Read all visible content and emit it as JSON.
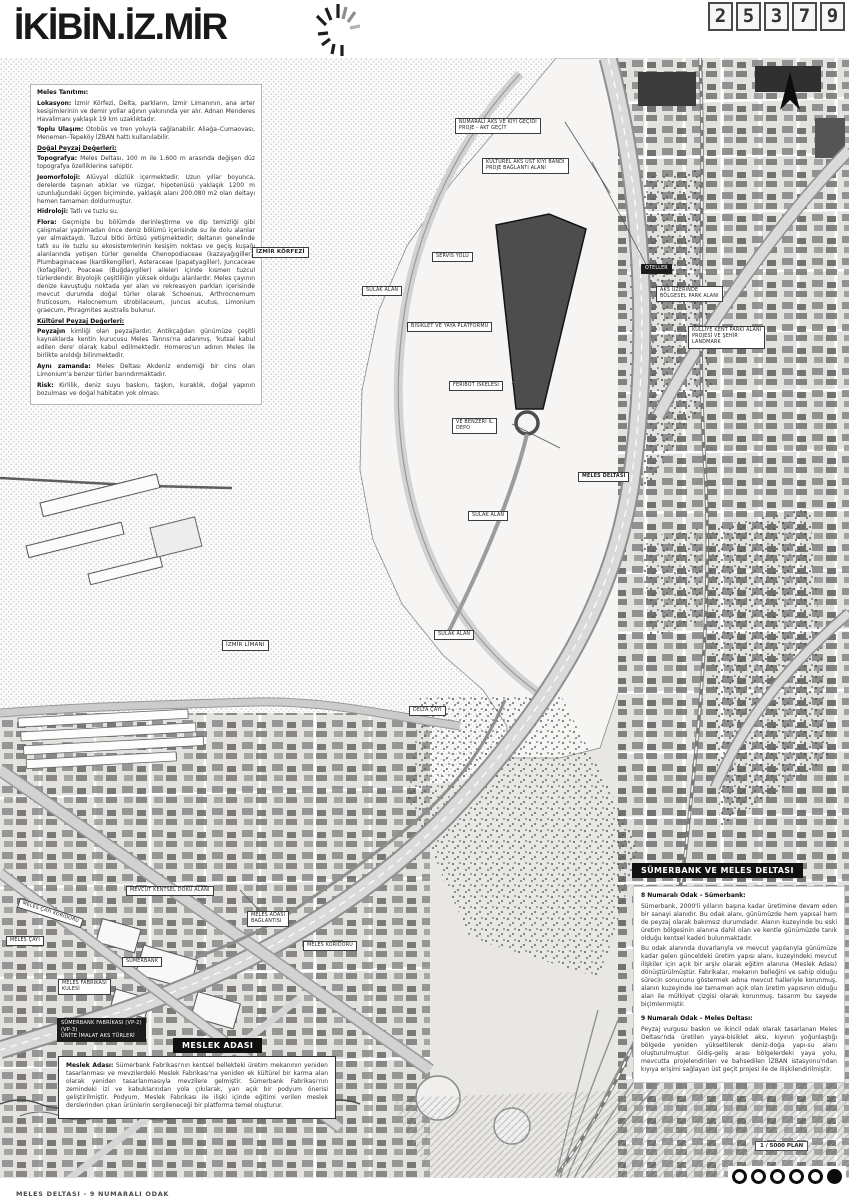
{
  "header": {
    "logo": "İKİBİN.İZ.MİR",
    "code_digits": [
      "2",
      "5",
      "3",
      "7",
      "9"
    ]
  },
  "footer": {
    "caption": "MELES DELTASI - 9 NUMARALI ODAK",
    "scale": "1 / 5000 PLAN"
  },
  "labels": {
    "callout1": "NUMARALI AKS VE KIYI GEÇİDİ\nPROJE - AKT GEÇİT",
    "callout2": "KÜLTÜREL AKS ÜST KIYI BANDI\nPROJE BAĞLANTI ALANI",
    "izmir_korfezi": "İZMİR KÖRFEZİ",
    "servis_yolu": "SERVİS YOLU",
    "sulak_alan_1": "SULAK ALAN",
    "bisiklet": "BİSİKLET VE YAYA PLATFORMU",
    "feribot": "FERİBOT İSKELESİ",
    "depo": "VE BENZERİ İL\nDEPO",
    "meles_deltasi": "MELES DELTASI",
    "sulak_alan_2": "SULAK ALAN",
    "izmir_limani": "İZMİR LİMANI",
    "sulak_alan_3": "SULAK ALAN",
    "delta_cayi": "DELTA ÇAYI",
    "oteller": "OTELLER",
    "aks_parki": "AKS ÜZERİNDE\nBÖLGESEL PARK ALANI",
    "landmark": "KÜLLİYE KENT PARKI ALANI\nPROJESİ VE ŞEHİR\nLANDMARK",
    "mevcut_doku": "MEVCUT KENTSEL DOKU ALANI",
    "koridor": "MELES ÇAYI KORİDORU",
    "meles_cayi": "MELES ÇAYI",
    "sumerbank": "SÜMERBANK",
    "fabrika": "MELES FABRİKASI\nKULESİ",
    "adasi_baglanti": "MELES ADASI\nBAĞLANTISI",
    "meles_koridoru": "MELES KORİDORU",
    "vp_box": "SÜMERBANK FABRİKASI (VP-2)\n(VP-3)\nÜNİTE İMALAT AKS TÜRLERİ"
  },
  "info": {
    "p1": {
      "b": "Meles Tanıtımı:",
      "t": ""
    },
    "p2": {
      "b": "Lokasyon:",
      "t": "İzmir Körfezi, Delta, parkların, İzmir Limanının, ana arter kesişimlerinin ve demir yollar ağının yakınında yer alır. Adnan Menderes Havalimanı yaklaşık 19 km uzaklıktadır."
    },
    "p3": {
      "b": "Toplu Ulaşım:",
      "t": "Otobüs ve tren yoluyla sağlanabilir. Aliağa–Cumaovası, Menemen–Tepeköy İZBAN hattı kullanılabilir."
    },
    "p4": {
      "b": "Doğal Peyzaj Değerleri:",
      "t": ""
    },
    "p5": {
      "b": "Topografya:",
      "t": "Meles Deltası, 100 m ile 1.600 m arasında değişen düz topografya özelliklerine sahiptir."
    },
    "p6": {
      "b": "Jeomorfoloji:",
      "t": "Alüvyal düzlük içermektedir. Uzun yıllar boyunca, derelerde taşınan atıklar ve rüzgar, hipotenüsü yaklaşık 1200 m uzunluğundaki üçgen biçiminde, yaklaşık alanı 200.080 m2 olan deltayı hemen tamamen doldurmuştur."
    },
    "p7": {
      "b": "Hidroloji:",
      "t": "Tatlı ve tuzlu su."
    },
    "p8": {
      "b": "Flora:",
      "t": "Geçmişte bu bölümde derinleştirme ve dip temizliği gibi çalışmalar yapılmadan önce deniz bölümü içerisinde su ile dolu alanlar yer almaktaydı. Tuzcul bitki örtüsü yetişmektedir; deltanın genelinde tatlı su ile tuzlu su ekosistemlerinin kesişim noktası ve geçiş kuşağı alanlarında yetişen türler genelde Chenopodiaceae (kazayağıgiller), Plumbaginaceae (kardikengiller), Asteraceae (papatyagiller), Juncaceae (kofagiller), Poaceae (Buğdaygiller) aileleri içinde kısmen tuzcul türlerdendir. Biyolojik çeşitliliğin yüksek olduğu alanlardır. Meles çayının denize kavuştuğu noktada yer alan ve rekreasyon parkları içerisinde mevcut durumda doğal türler olarak Schoenus, Arthrocnemum fruticosum, Halocnemum strobilaceum, Juncus acutus, Limonium graecum, Phragmites australis bulunur."
    },
    "p9": {
      "b": "Kültürel Peyzaj Değerleri:",
      "t": ""
    },
    "p10": {
      "b": "Peyzajın",
      "t": "kimliği olan peyzajlardır; Antikçağdan günümüze çeşitli kaynaklarda kentin kurucusu Meles Tanrısı'na adanmış, 'kutsal kabul edilen dere' olarak kabul edilmektedir. Homeros'un adının Meles ile birlikte anıldığı bilinmektedir."
    },
    "p11": {
      "b": "Aynı zamanda:",
      "t": "Meles Deltası Akdeniz endemiği bir cins olan Limonium'a benzer türler barındırmaktadır."
    },
    "p12": {
      "b": "Risk:",
      "t": "Kirlilik, deniz suyu baskını, taşkın, kuraklık, doğal yapının bozulması ve doğal habitatın yok olması."
    }
  },
  "meslek": {
    "header": "MESLEK ADASI",
    "p1": {
      "b": "Meslek Adası:",
      "t": "Sümerbank Fabrikası'nın kentsel bellekteki üretim mekanının yeniden tasarlanması ve mevzilerdeki Meslek Fabrikası'na yeniden ek kültürel bir karma alan olarak yeniden tasarlanmasıyla mevzilere gelmiştir. Sümerbank Fabrikası'nın zemindeki izi ve kabuklarından yola çıkılarak, yarı açık bir podyum önerisi geliştirilmiştir. Podyum, Meslek Fabrikası ile ilişki içinde eğitimi verilen meslek derslerinden çıkan ürünlerin sergileneceği bir platforma temel oluşturur."
    }
  },
  "sumer": {
    "header": "SÜMERBANK VE MELES DELTASI",
    "s1": {
      "b": "8 Numaralı Odak – Sümerbank:",
      "t": ""
    },
    "s2": {
      "b": "",
      "t": "Sümerbank, 2000'li yılların başına kadar üretimine devam eden bir sanayi alanıdır. Bu odak alanı, günümüzde hem yapısal hem de peyzaj olarak bakımsız durumdadır. Alanın kuzeyinde bu eski üretim bölgesinin alanına dahil olan ve kentle günümüzde tanık olduğu kentsel kaderi bulunmaktadır."
    },
    "s3": {
      "b": "",
      "t": "Bu odak alanında duvarlarıyla ve mevcut yapılarıyla günümüze kadar gelen günceldeki üretim yapısı alanı, kuzeyindeki mevcut ilişkiler için açık bir arşiv olarak eğitim alanına (Meslek Adası) dönüştürülmüştür. Fabrikalar, mekanın belleğini ve sahip olduğu sürecin sonucunu göstermek adına mevcut halleriyle korunmuş, alanın kuzeyinde ise tamamen açık olan üretim yapısının olduğu alan ile mülkiyet çizgisi olarak korunmuş, tasarım bu sayede biçimlenmiştir."
    },
    "s4": {
      "b": "9 Numaralı Odak – Meles Deltası:",
      "t": ""
    },
    "s5": {
      "b": "",
      "t": "Peyzaj vurgusu baskın ve ikincil odak olarak tasarlanan Meles Deltası'nda üretilen yaya-bisiklet aksı, kıyının yoğunlaştığı bölgede yeniden yükseltilerek deniz-doğa yapı-su alanı oluşturulmuştur. Gidiş-geliş arası bölgelerdeki yaya yolu, mevcutta projelendirilen ve bahsedilen İZBAN istasyonu'ndan kıyıya erişimi sağlayan üst geçit projesi ile de ilişkilendirilmiştir."
    }
  }
}
